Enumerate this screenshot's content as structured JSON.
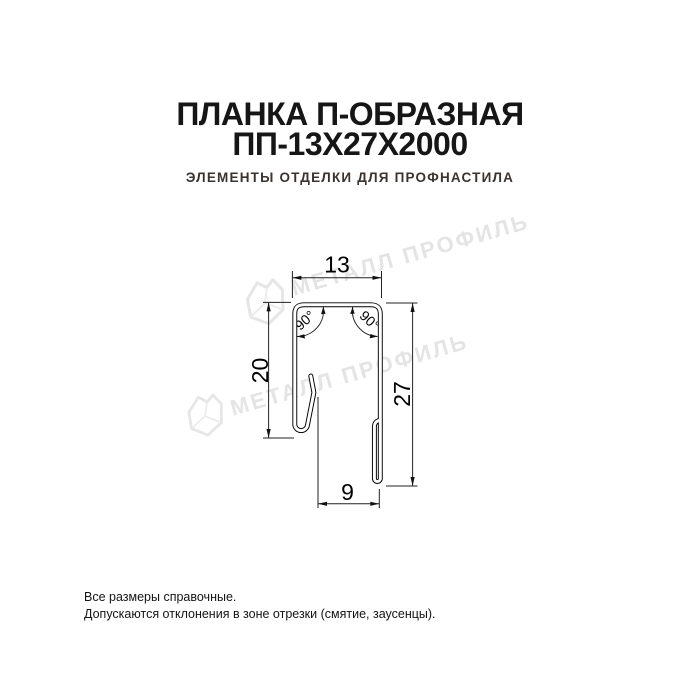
{
  "header": {
    "title_line1": "ПЛАНКА П-ОБРАЗНАЯ",
    "title_line2": "ПП-13Х27Х2000",
    "subtitle": "ЭЛЕМЕНТЫ ОТДЕЛКИ ДЛЯ ПРОФНАСТИЛА"
  },
  "watermark": {
    "text": "МЕТАЛЛ ПРОФИЛЬ",
    "color": "#e4e4e4"
  },
  "diagram": {
    "description": "Cross-section of U-shaped metal strip with hemmed flared edges",
    "dim_top_width": "13",
    "dim_left_height": "20",
    "dim_right_height": "27",
    "dim_bottom_width": "9",
    "angle_left": "90°",
    "angle_right": "90°",
    "line_color": "#000000"
  },
  "footer": {
    "line1": "Все размеры справочные.",
    "line2": "Допускаются отклонения в зоне отрезки (смятие, заусенцы)."
  }
}
